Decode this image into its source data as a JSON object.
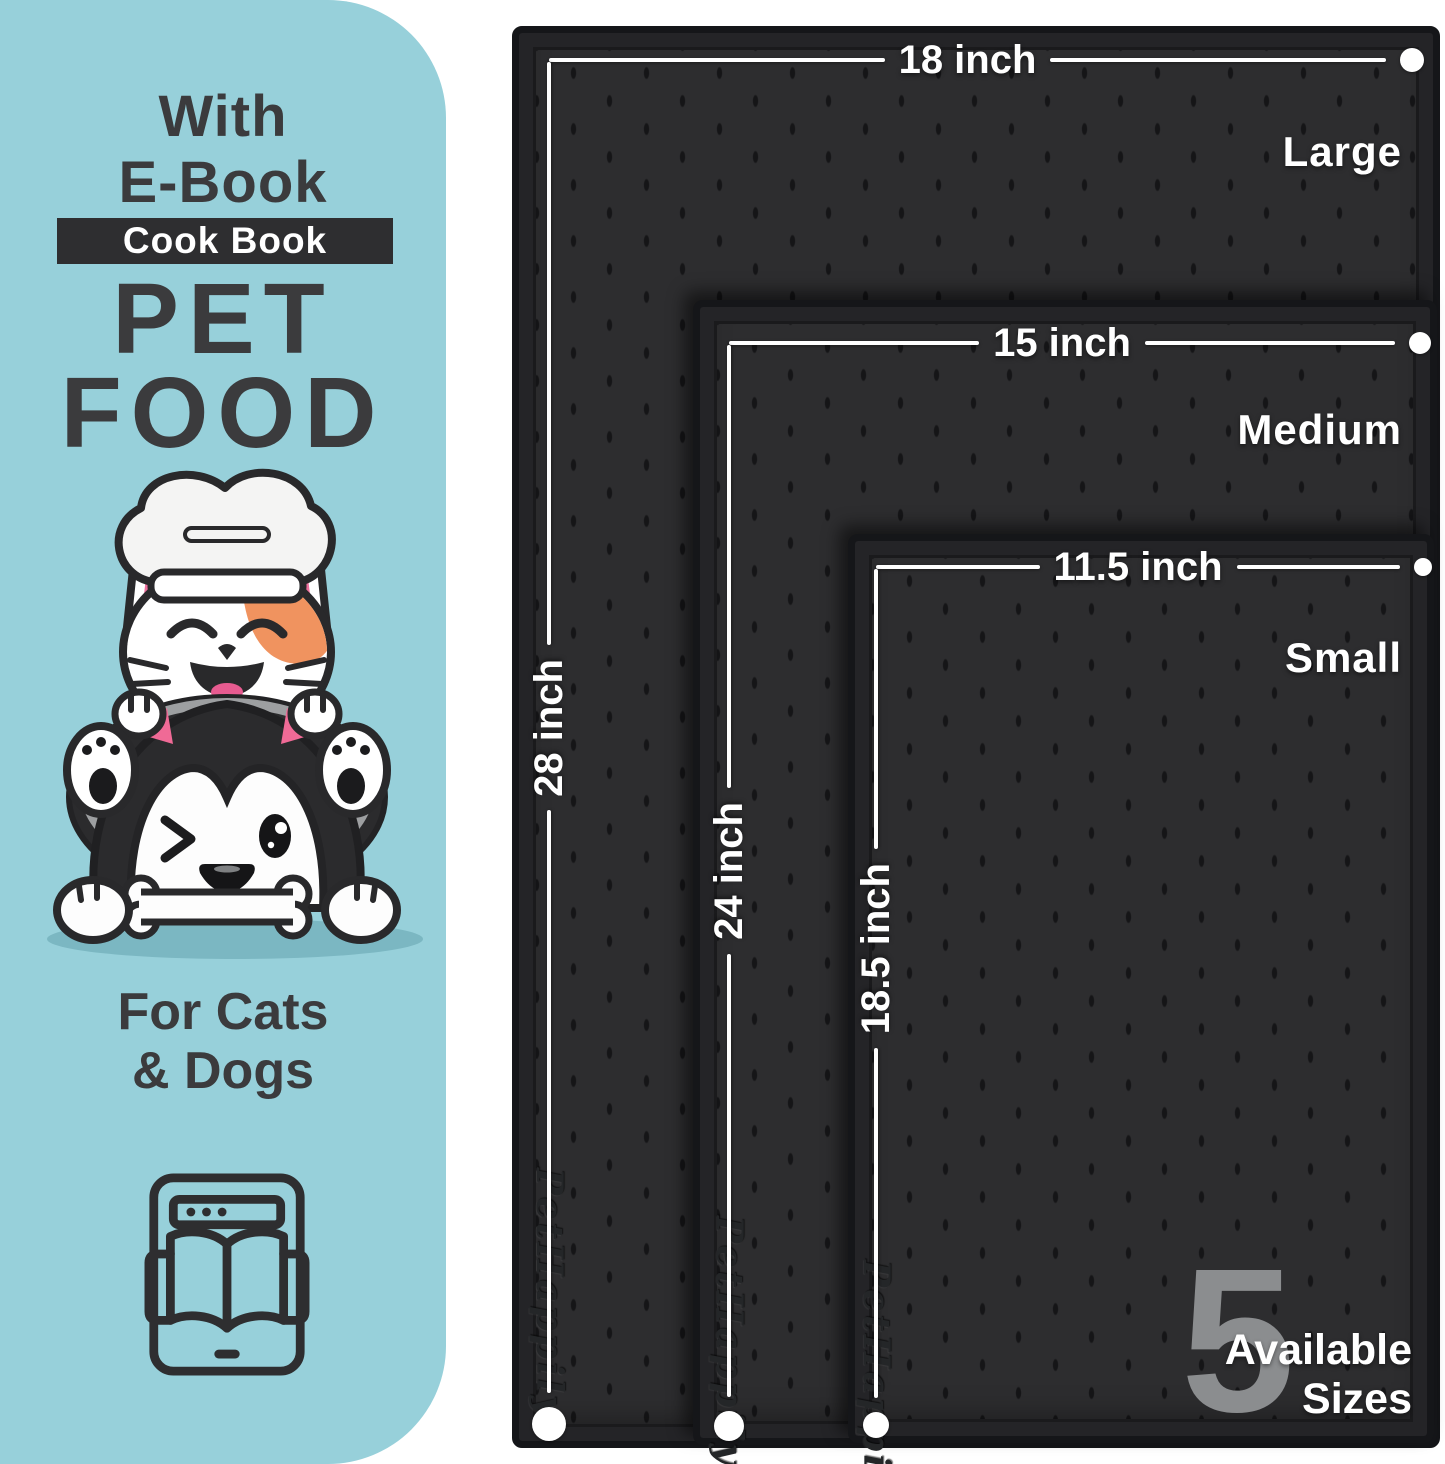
{
  "panel": {
    "heading_line1": "With",
    "heading_line2": "E-Book",
    "badge_label": "Cook Book",
    "title_line1": "PET",
    "title_line2": "FOOD",
    "subtitle_line1": "For Cats",
    "subtitle_line2": "& Dogs",
    "illustration": "cat-chef-and-winking-dog-with-bone-on-bowl",
    "icon": "ebook-tablet-open-book-icon"
  },
  "mats": [
    {
      "name": "large",
      "size_label": "Large",
      "width_label": "18 inch",
      "height_label": "28 inch",
      "brand_emboss": "PetHappily"
    },
    {
      "name": "medium",
      "size_label": "Medium",
      "width_label": "15 inch",
      "height_label": "24 inch",
      "brand_emboss": "PetHappily"
    },
    {
      "name": "small",
      "size_label": "Small",
      "width_label": "11.5 inch",
      "height_label": "18.5 inch",
      "brand_emboss": "PetHappily"
    }
  ],
  "availability": {
    "count": "5",
    "line1": "Available",
    "line2": "Sizes"
  },
  "colors": {
    "panel_bg": "#97d0da",
    "dark_text": "#3b3b3d",
    "badge_bg": "#2e2e30",
    "mat_surface": "#2d2d2f",
    "mat_edge": "#151619",
    "dimension_white": "#ffffff",
    "count_gray": "#8b8d8f",
    "patch_orange": "#f0935f",
    "tongue_pink": "#e75b90",
    "ear_pink": "#ee6f9d",
    "shadow_teal": "#7bb7c2"
  }
}
